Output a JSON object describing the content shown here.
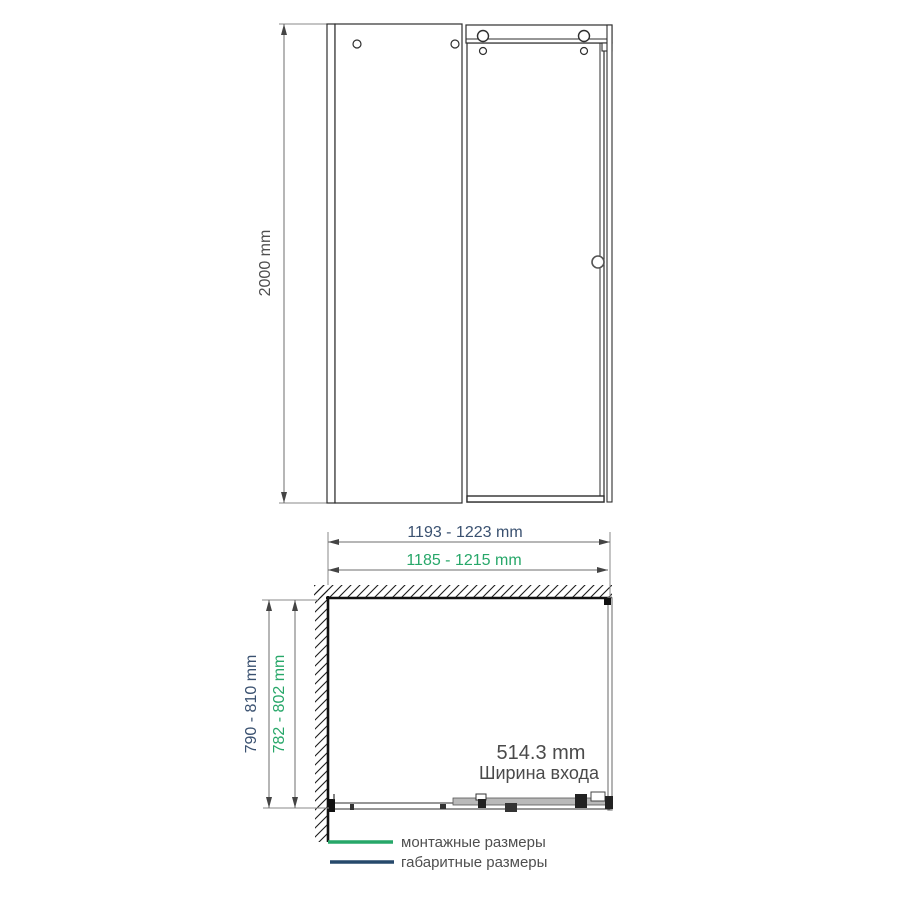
{
  "front_view": {
    "height_dim": "2000 mm"
  },
  "plan_view": {
    "overall_width_dim": "1193 - 1223 mm",
    "mounting_width_dim": "1185 - 1215 mm",
    "overall_depth_dim": "790 - 810 mm",
    "mounting_depth_dim": "782 - 802 mm",
    "entrance_width_value": "514.3 mm",
    "entrance_width_label": "Ширина входа"
  },
  "legend": {
    "mounting_label": "монтажные размеры",
    "overall_label": "габаритные размеры"
  },
  "colors": {
    "mounting_green": "#27a769",
    "overall_blue_text": "#3a5170",
    "overall_blue_line": "#26496b",
    "outline_dark": "#2e2e2e",
    "dimension_gray": "#6e6e6e",
    "text_gray": "#4f4f4f",
    "wall_black": "#111111",
    "glass_gray": "#b9b9b9"
  }
}
